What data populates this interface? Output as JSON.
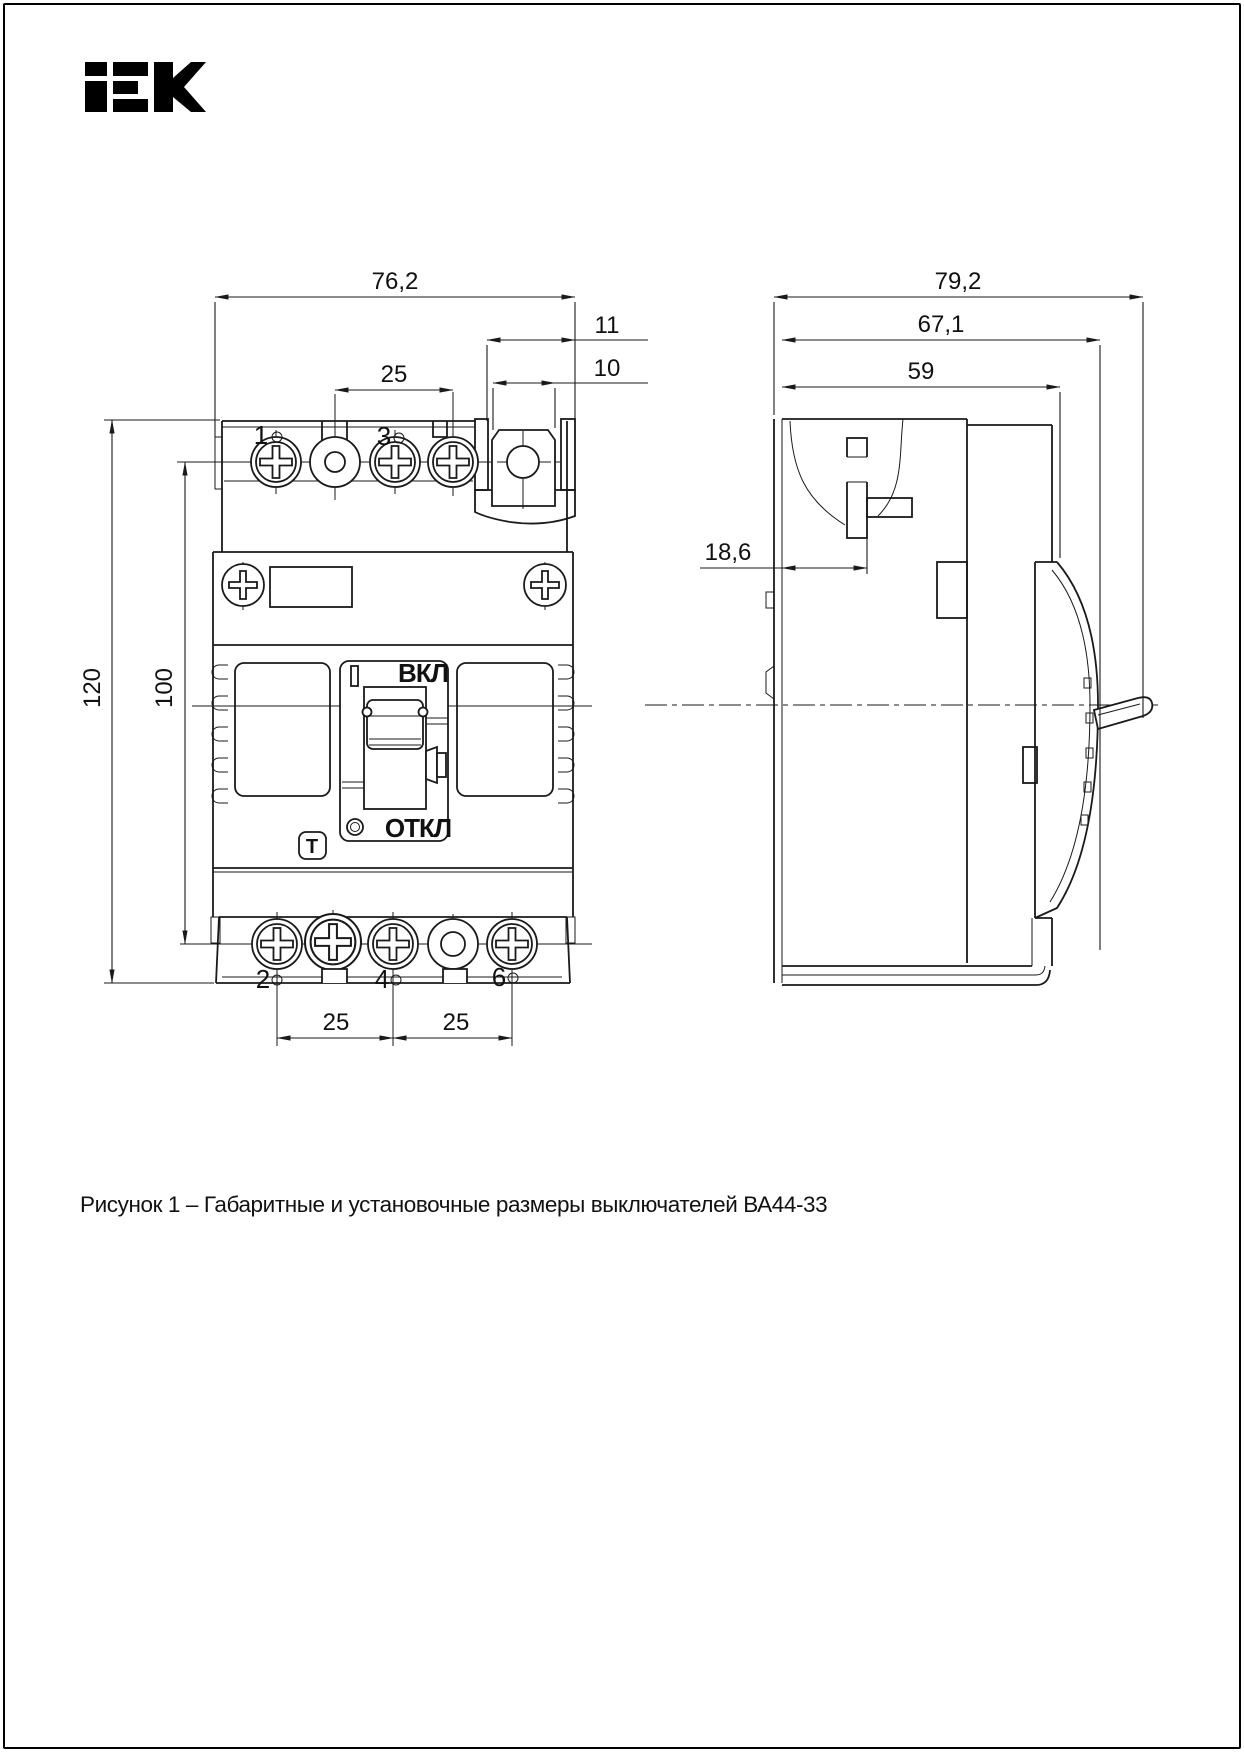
{
  "brand": {
    "logo_text": "iEK"
  },
  "caption": "Рисунок 1 – Габаритные и установочные размеры выключателей ВА44-33",
  "front_view": {
    "dimensions": {
      "overall_width": "76,2",
      "top_terminal_pitch": "25",
      "terminal_slot_offset": "11",
      "terminal_slot_width": "10",
      "overall_height": "120",
      "mounting_height": "100",
      "bottom_pitch_left": "25",
      "bottom_pitch_right": "25"
    },
    "labels": {
      "on": "ВКЛ",
      "off": "ОТКЛ",
      "test_button": "T",
      "terminal_1": "1",
      "terminal_3": "3",
      "terminal_2": "2",
      "terminal_4": "4",
      "terminal_6": "6"
    }
  },
  "side_view": {
    "dimensions": {
      "overall_depth": "79,2",
      "depth_with_handle_base": "67,1",
      "body_depth": "59",
      "terminal_pocket_depth": "18,6"
    }
  },
  "colors": {
    "line": "#1a1a1a",
    "background": "#ffffff"
  }
}
